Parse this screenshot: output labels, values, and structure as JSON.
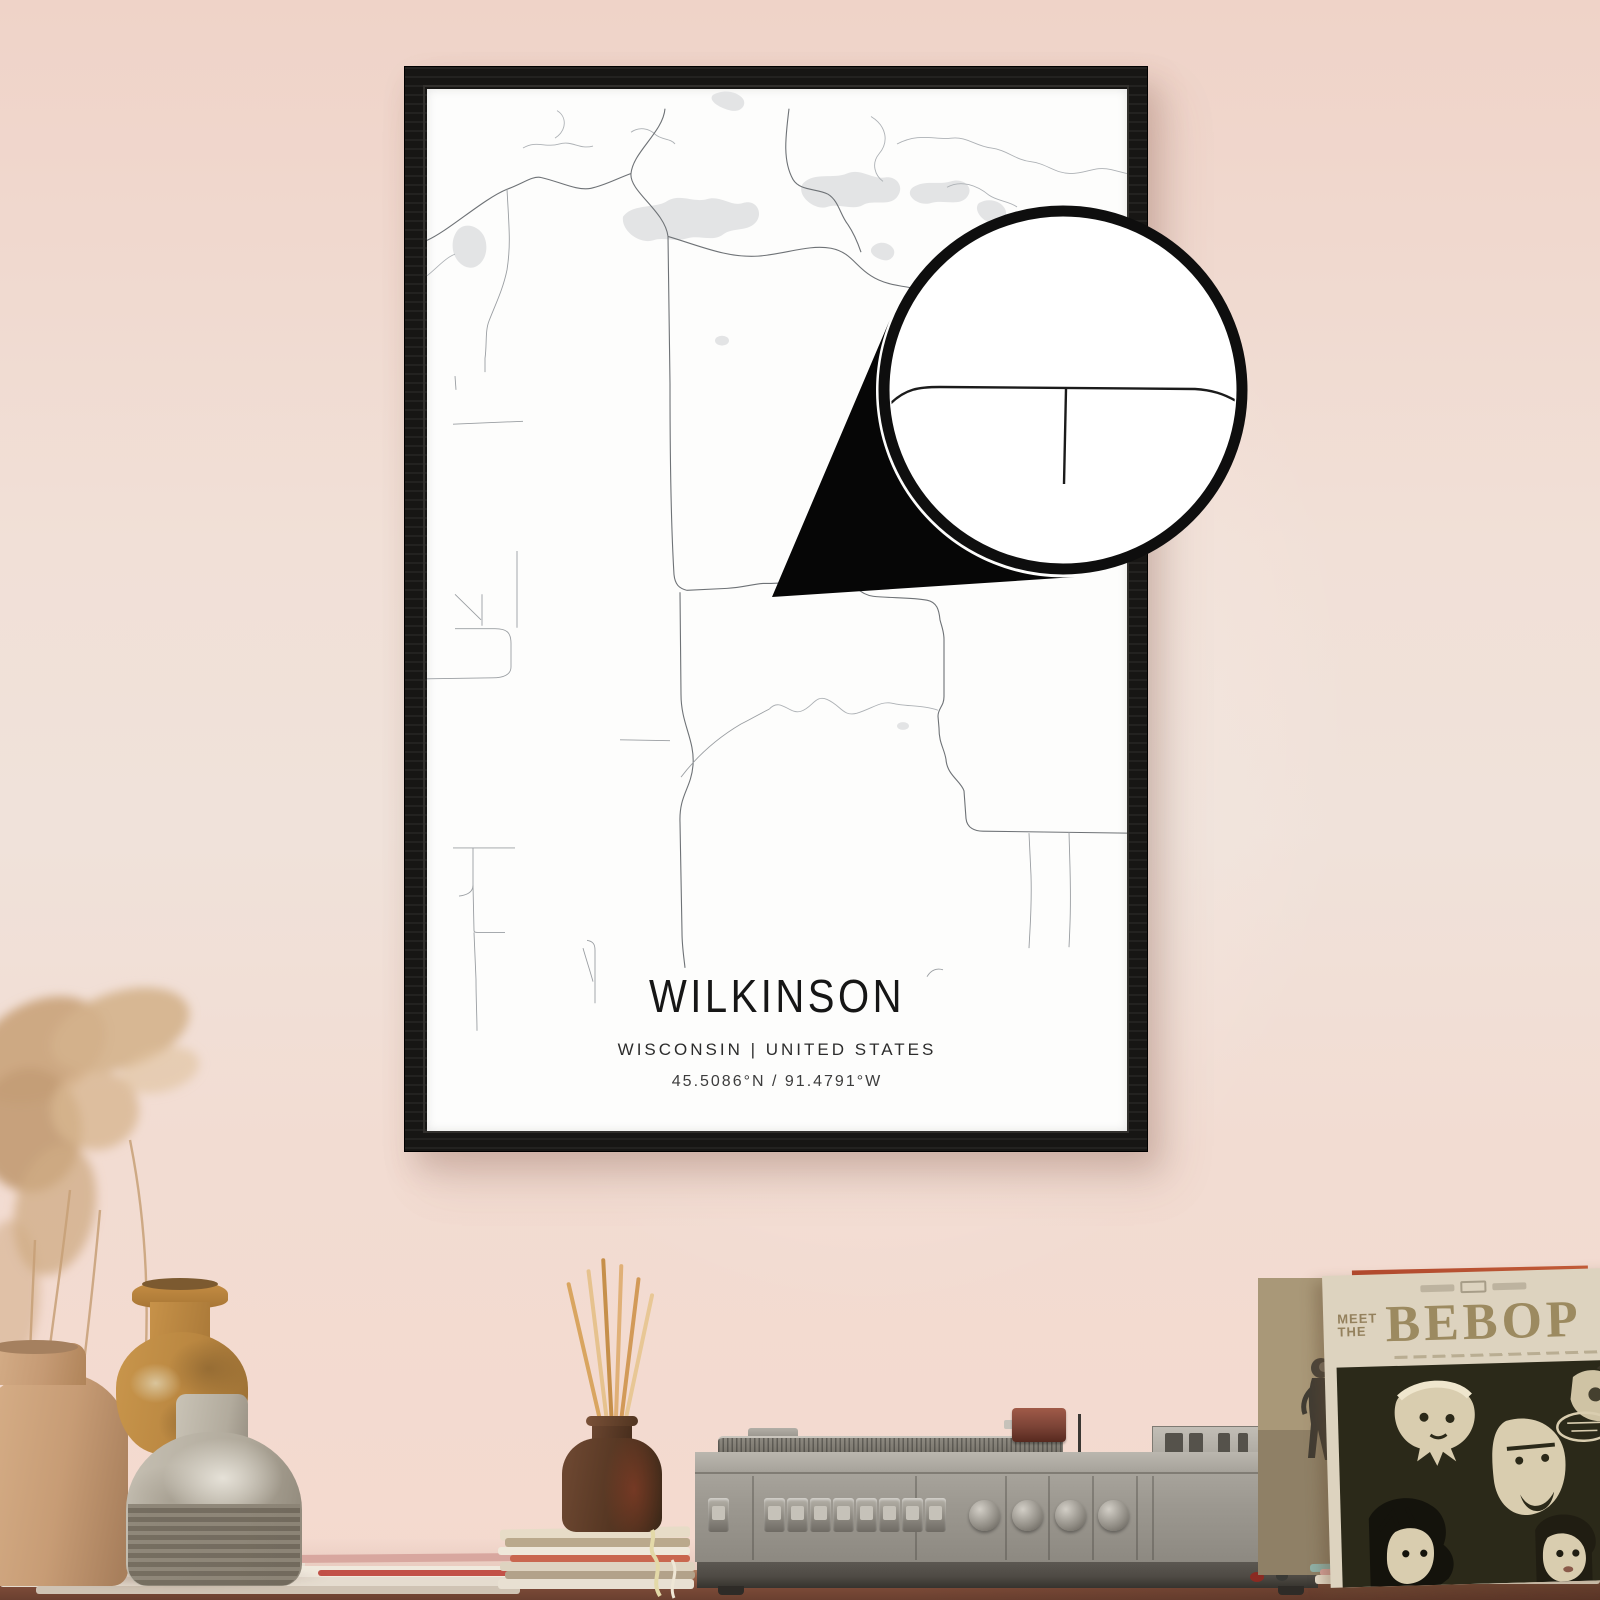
{
  "poster": {
    "title": "WILKINSON",
    "subtitle": "WISCONSIN | UNITED STATES",
    "coordinates": "45.5086°N / 91.4791°W"
  },
  "record_sleeve": {
    "meet": "MEET",
    "the": "THE",
    "bebop": "BEBOP"
  },
  "colors": {
    "wall-top": "#efd3c8",
    "wall-mid": "#f0e2da",
    "wall-bottom": "#f4d9ce",
    "frame": "#171614",
    "poster-bg": "#fdfdfc",
    "ink": "#1d1d1d",
    "map-road": "#6e7276",
    "map-road-light": "#9a9ea2",
    "map-river": "#adb1b5",
    "map-water": "#e3e4e5",
    "magnifier-line": "#1b1b1b",
    "table-top": "#9a6248",
    "table-dark": "#6a4030",
    "sleeve-paper": "#ddd3bf",
    "sleeve-ink": "#94815d",
    "sleeve-art-bg": "#2b2919",
    "player-body": "#9b978f",
    "player-base": "#4e4a44"
  }
}
